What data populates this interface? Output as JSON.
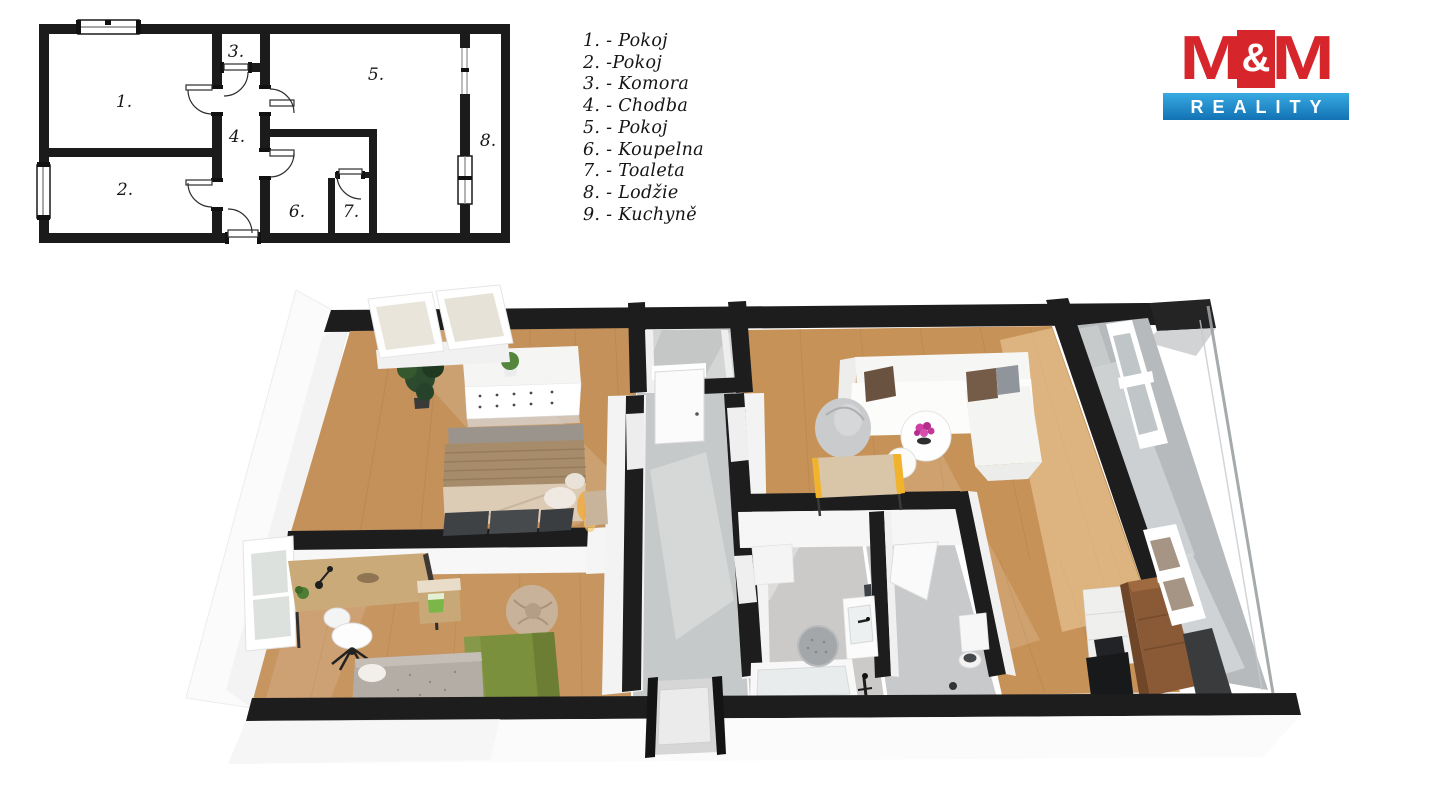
{
  "plan2d": {
    "labels": [
      "1.",
      "2.",
      "3.",
      "4.",
      "5.",
      "6.",
      "7.",
      "8."
    ]
  },
  "legend": {
    "items": [
      "1. - Pokoj",
      "2. -Pokoj",
      "3. - Komora",
      "4. - Chodba",
      "5. - Pokoj",
      "6. - Koupelna",
      "7. - Toaleta",
      "8. - Lodžie",
      "9. - Kuchyně"
    ]
  },
  "logo": {
    "m1": "M",
    "amp": "&",
    "m2": "M",
    "subtitle": "REALITY"
  },
  "colors": {
    "logo_red": "#d6262c",
    "logo_blue": "#1b85c4",
    "wall_black": "#1d1d1e",
    "wood_floor": "#c4915a",
    "corridor_gray": "#c6c9ca",
    "loggia_gray": "#b6babc"
  }
}
